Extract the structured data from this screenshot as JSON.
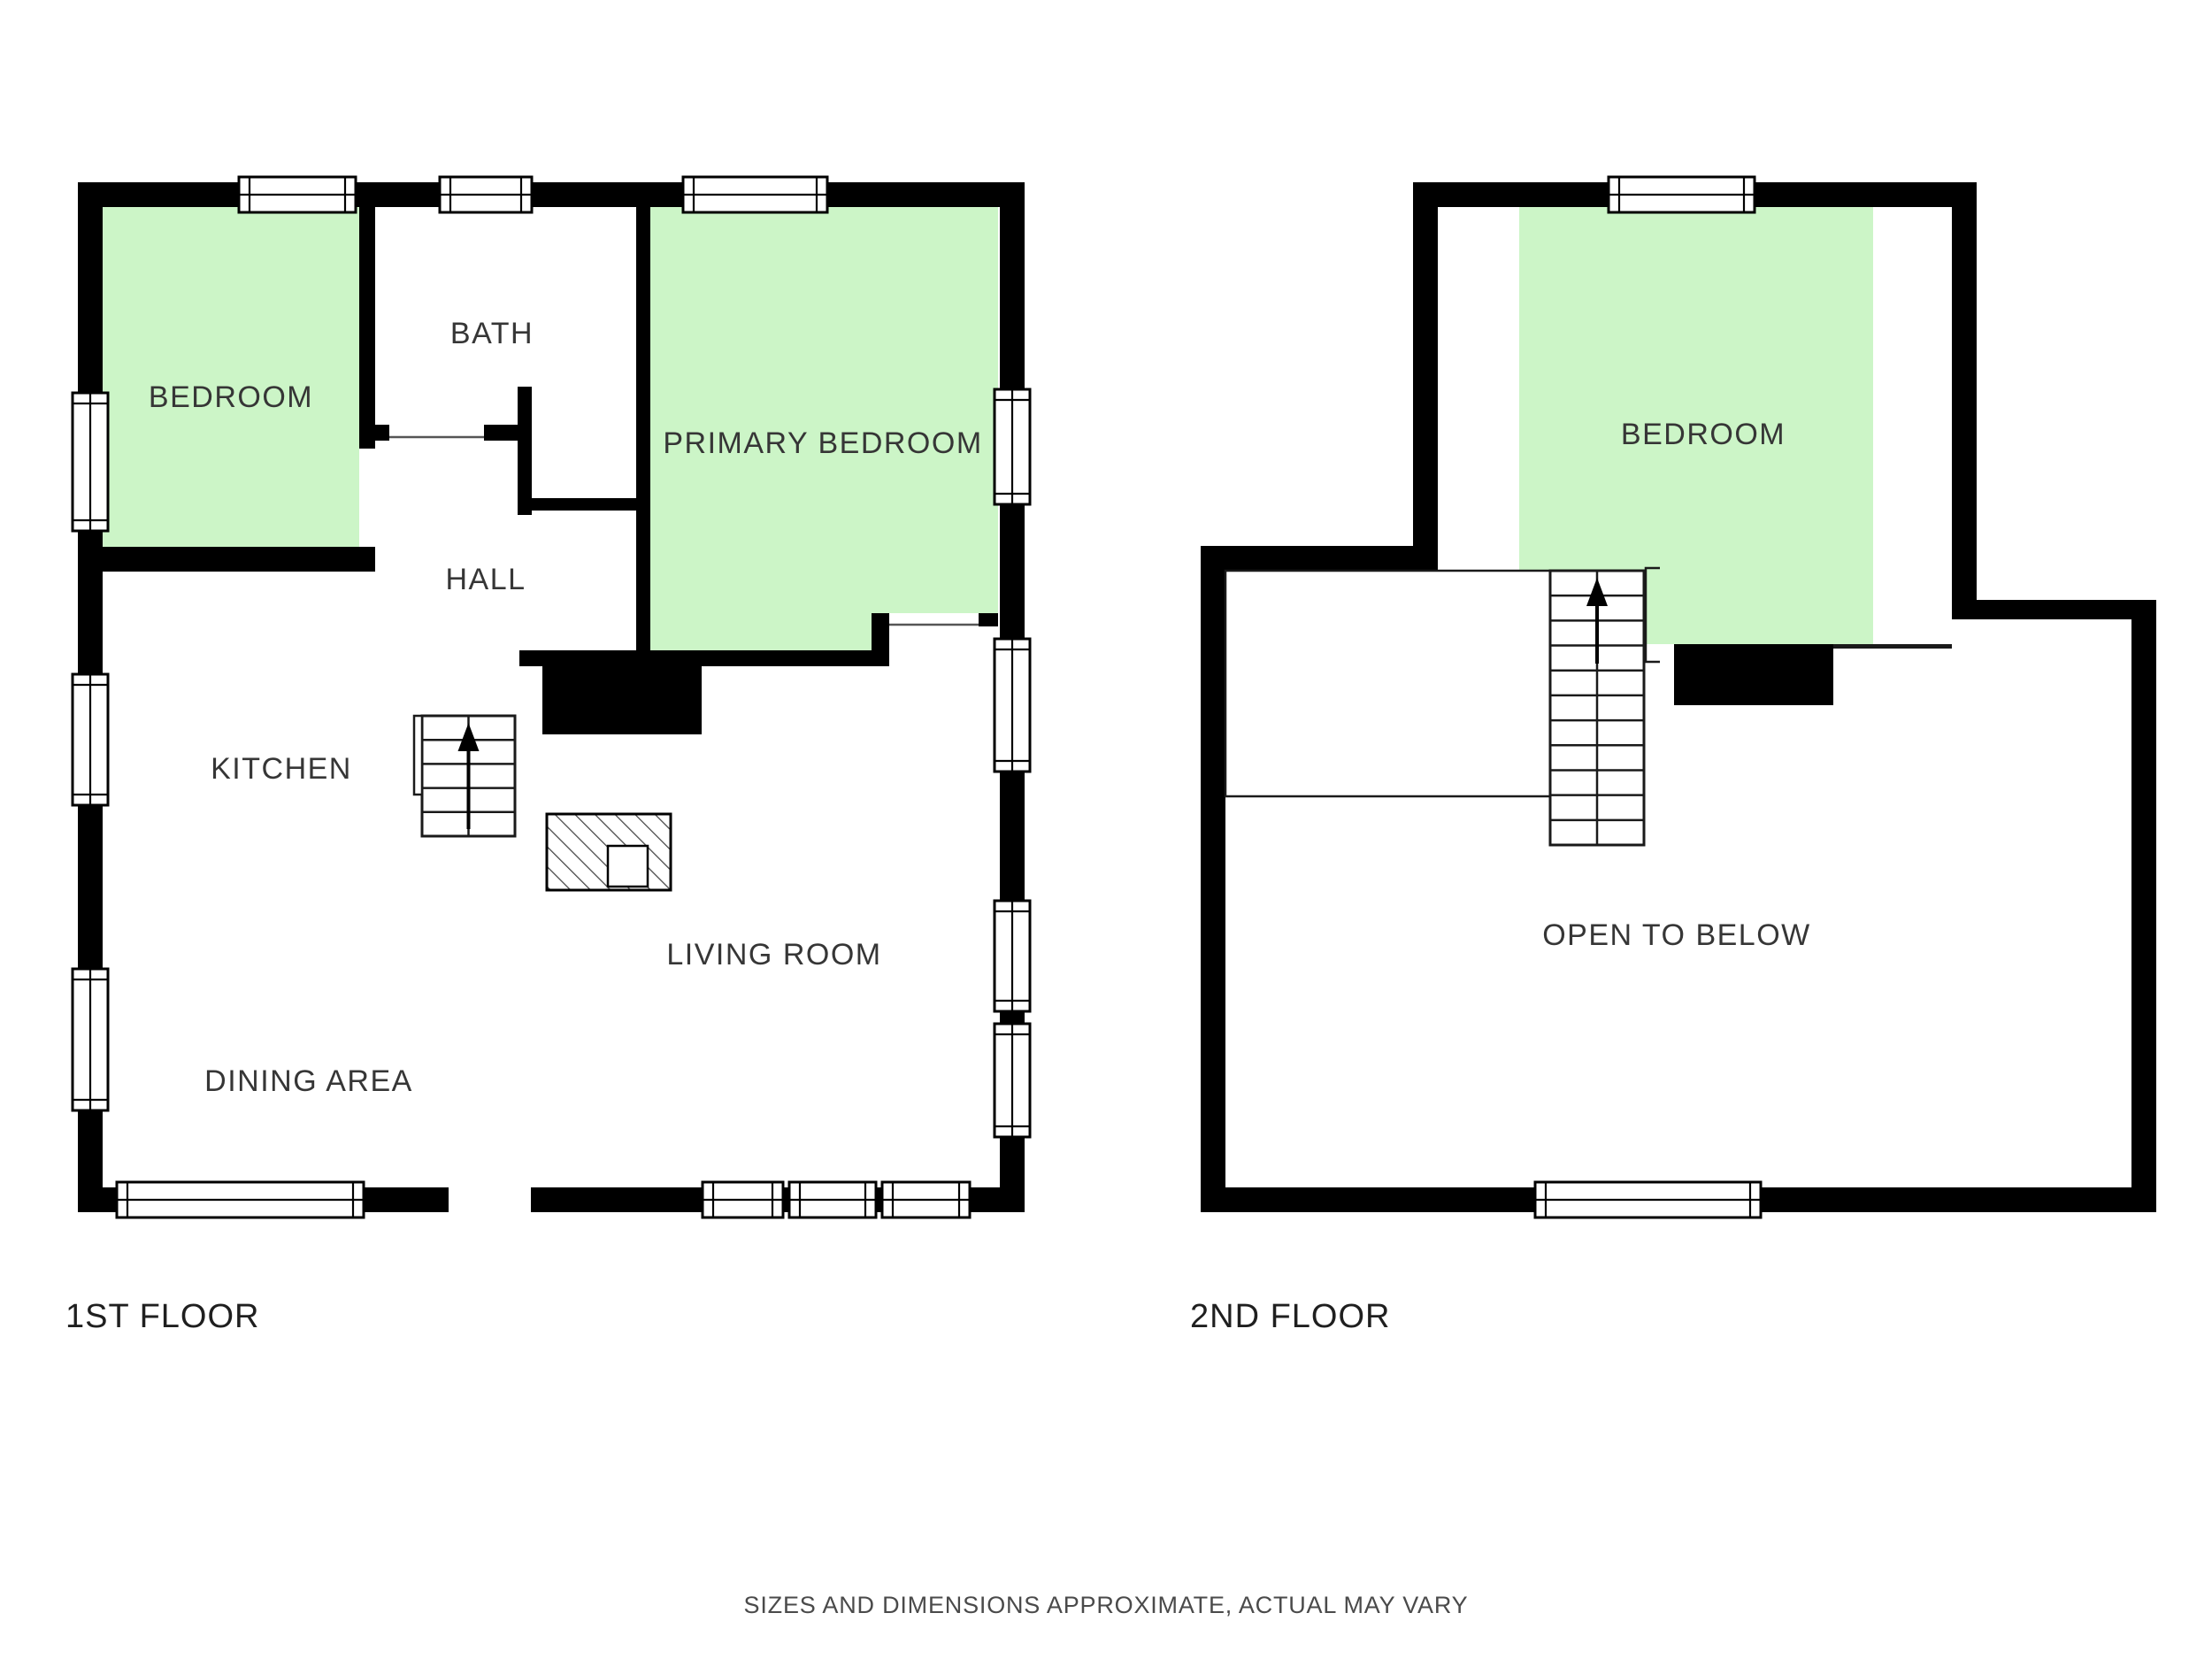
{
  "colors": {
    "background": "#ffffff",
    "wall": "#000000",
    "room_highlight": "#ccf5c7",
    "room_label": "#363636",
    "floor_label": "#1f1f1f",
    "disclaimer": "#4a4a4a"
  },
  "floors": [
    {
      "name": "1ST FLOOR",
      "rooms": {
        "bedroom": "BEDROOM",
        "bath": "BATH",
        "primary_bedroom": "PRIMARY BEDROOM",
        "hall": "HALL",
        "kitchen": "KITCHEN",
        "living_room": "LIVING ROOM",
        "dining_area": "DINING AREA"
      }
    },
    {
      "name": "2ND FLOOR",
      "rooms": {
        "bedroom": "BEDROOM",
        "open_to_below": "OPEN TO BELOW"
      }
    }
  ],
  "footer": {
    "disclaimer": "SIZES AND DIMENSIONS APPROXIMATE, ACTUAL MAY VARY"
  }
}
